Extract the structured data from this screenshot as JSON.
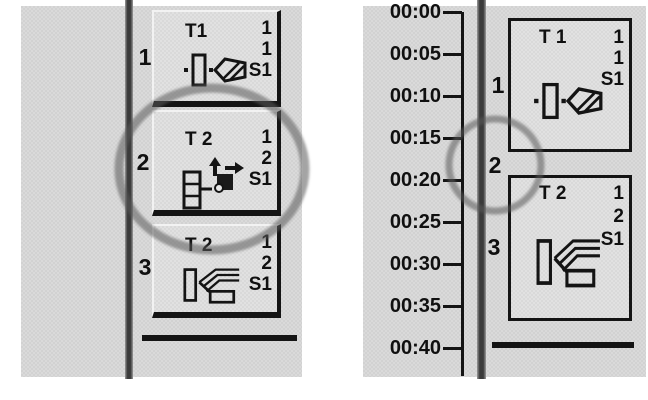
{
  "colors": {
    "page_bg": "#ffffff",
    "panel_bg": "#d7d7d7",
    "block_bg": "#dedede",
    "separator_dark": "#3b3b3b",
    "border_black": "#141414",
    "highlight_circle": "#5a5a5a",
    "text": "#101010"
  },
  "left_panel": {
    "steps": [
      {
        "index": "1",
        "name": "T1",
        "val1": "1",
        "val2": "1",
        "source": "S1",
        "icon": "valve-step-icon"
      },
      {
        "index": "2",
        "name": "T 2",
        "val1": "1",
        "val2": "2",
        "source": "S1",
        "icon": "transfer-step-icon"
      },
      {
        "index": "3",
        "name": "T 2",
        "val1": "1",
        "val2": "2",
        "source": "S1",
        "icon": "ramp-step-icon"
      }
    ]
  },
  "right_panel": {
    "time_labels": [
      "00:00",
      "00:05",
      "00:10",
      "00:15",
      "00:20",
      "00:25",
      "00:30",
      "00:35",
      "00:40"
    ],
    "steps": [
      {
        "index": "1",
        "name": "T 1",
        "val1": "1",
        "val2": "1",
        "source": "S1",
        "icon": "valve-step-icon"
      },
      {
        "index": "2"
      },
      {
        "index": "3",
        "name": "T 2",
        "val1": "1",
        "val2": "2",
        "source": "S1",
        "icon": "ramp-step-icon"
      }
    ]
  }
}
